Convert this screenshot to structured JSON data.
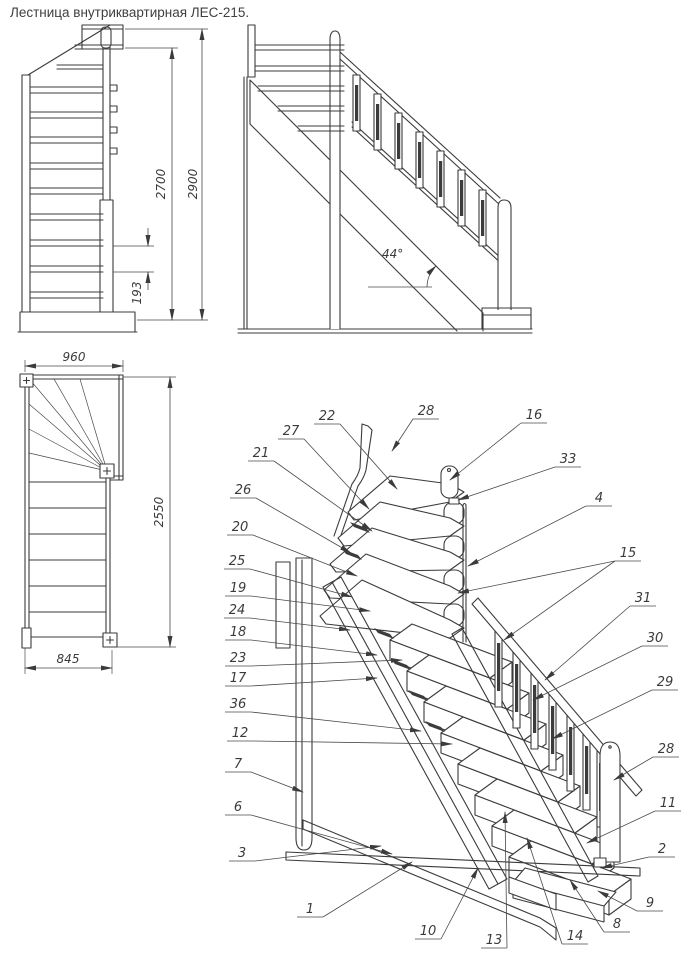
{
  "title": "Лестница внутриквартирная ЛЕС-215.",
  "front_view": {
    "height_flight": "2700",
    "height_total": "2900",
    "riser": "193"
  },
  "side_view": {
    "angle": "44°"
  },
  "plan_view": {
    "width_top": "960",
    "length": "2550",
    "width_bottom": "845"
  },
  "iso_view": {
    "callouts": [
      {
        "label": "22",
        "tx": 327,
        "ty": 420,
        "ax": 397,
        "ay": 489
      },
      {
        "label": "27",
        "tx": 291,
        "ty": 435,
        "ax": 369,
        "ay": 509
      },
      {
        "label": "21",
        "tx": 261,
        "ty": 457,
        "ax": 372,
        "ay": 531
      },
      {
        "label": "26",
        "tx": 243,
        "ty": 494,
        "ax": 351,
        "ay": 553
      },
      {
        "label": "20",
        "tx": 240,
        "ty": 531,
        "ax": 357,
        "ay": 576
      },
      {
        "label": "25",
        "tx": 237,
        "ty": 565,
        "ax": 352,
        "ay": 597
      },
      {
        "label": "19",
        "tx": 238,
        "ty": 592,
        "ax": 370,
        "ay": 611
      },
      {
        "label": "24",
        "tx": 237,
        "ty": 614,
        "ax": 350,
        "ay": 630
      },
      {
        "label": "18",
        "tx": 238,
        "ty": 636,
        "ax": 377,
        "ay": 655
      },
      {
        "label": "23",
        "tx": 238,
        "ty": 662,
        "ax": 402,
        "ay": 660
      },
      {
        "label": "17",
        "tx": 238,
        "ty": 682,
        "ax": 377,
        "ay": 678
      },
      {
        "label": "36",
        "tx": 238,
        "ty": 708,
        "ax": 421,
        "ay": 731
      },
      {
        "label": "12",
        "tx": 240,
        "ty": 737,
        "ax": 452,
        "ay": 744
      },
      {
        "label": "7",
        "tx": 238,
        "ty": 768,
        "ax": 303,
        "ay": 792
      },
      {
        "label": "6",
        "tx": 238,
        "ty": 811,
        "ax": 392,
        "ay": 854
      },
      {
        "label": "3",
        "tx": 242,
        "ty": 857,
        "ax": 381,
        "ay": 846
      },
      {
        "label": "1",
        "tx": 310,
        "ty": 913,
        "ax": 412,
        "ay": 862
      },
      {
        "label": "10",
        "tx": 428,
        "ty": 935,
        "ax": 478,
        "ay": 868
      },
      {
        "label": "13",
        "tx": 494,
        "ty": 944,
        "ax": 505,
        "ay": 812
      },
      {
        "label": "14",
        "tx": 575,
        "ty": 940,
        "ax": 527,
        "ay": 838
      },
      {
        "label": "8",
        "tx": 617,
        "ty": 928,
        "ax": 570,
        "ay": 880
      },
      {
        "label": "9",
        "tx": 650,
        "ty": 907,
        "ax": 598,
        "ay": 891
      },
      {
        "label": "2",
        "tx": 662,
        "ty": 853,
        "ax": 601,
        "ay": 868
      },
      {
        "label": "11",
        "tx": 668,
        "ty": 807,
        "ax": 587,
        "ay": 843
      },
      {
        "label": "28",
        "tx": 666,
        "ty": 753,
        "ax": 614,
        "ay": 780
      },
      {
        "label": "29",
        "tx": 665,
        "ty": 686,
        "ax": 552,
        "ay": 739
      },
      {
        "label": "30",
        "tx": 655,
        "ty": 642,
        "ax": 533,
        "ay": 700
      },
      {
        "label": "31",
        "tx": 643,
        "ty": 602,
        "ax": 545,
        "ay": 680
      },
      {
        "label": "15",
        "tx": 628,
        "ty": 557,
        "ax": 458,
        "ay": 593,
        "ax2": 504,
        "ay2": 640
      },
      {
        "label": "4",
        "tx": 599,
        "ty": 502,
        "ax": 468,
        "ay": 566
      },
      {
        "label": "33",
        "tx": 568,
        "ty": 463,
        "ax": 458,
        "ay": 500
      },
      {
        "label": "16",
        "tx": 534,
        "ty": 419,
        "ax": 450,
        "ay": 480
      },
      {
        "label": "28",
        "tx": 426,
        "ty": 415,
        "ax": 392,
        "ay": 451
      }
    ]
  },
  "colors": {
    "line": "#3b3b3b",
    "background": "#ffffff"
  }
}
